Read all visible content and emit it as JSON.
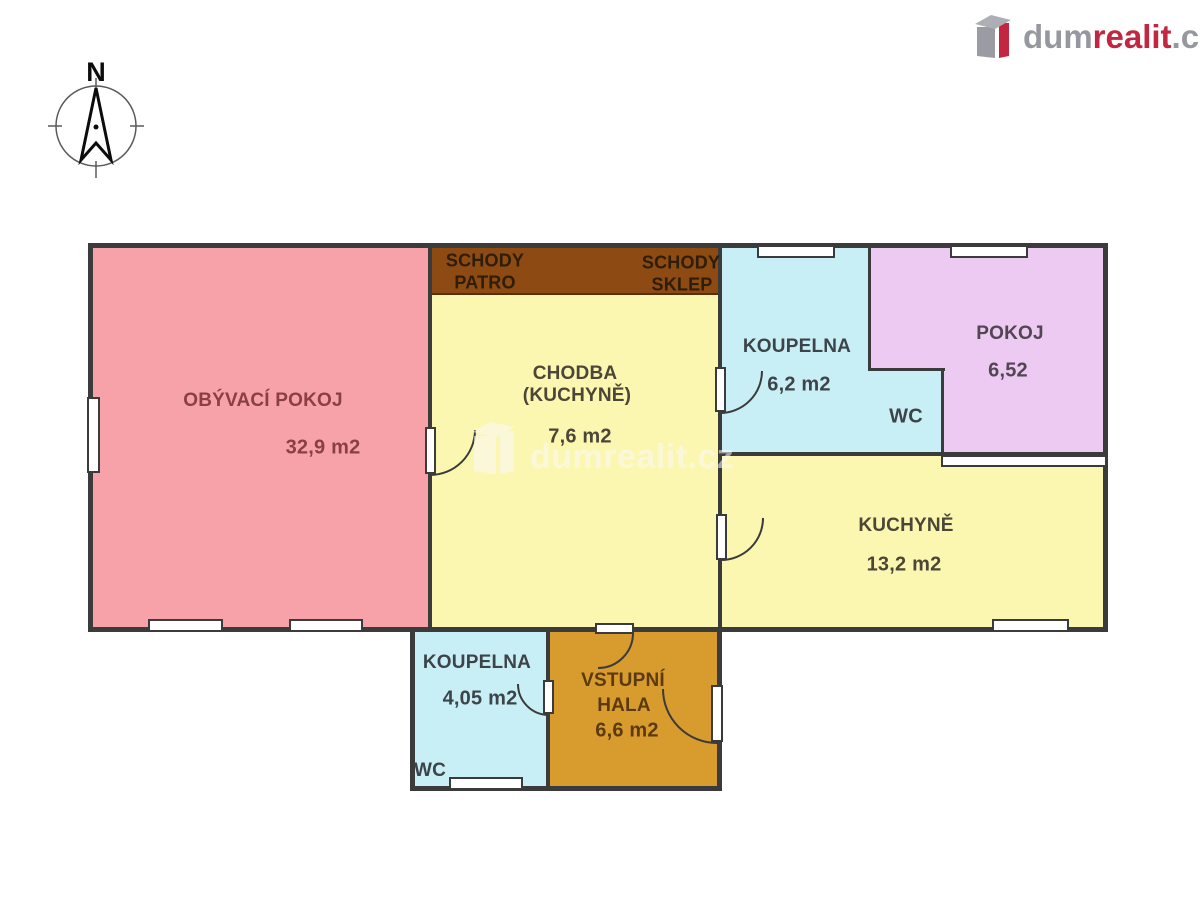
{
  "brand": {
    "dum": "dum",
    "realit": "realit",
    "cz": ".cz"
  },
  "compass": {
    "north": "N"
  },
  "watermark": {
    "text": "dumrealit.cz"
  },
  "plan": {
    "obyvaci_pokoj": {
      "name": "OBÝVACÍ POKOJ",
      "area": "32,9 m2"
    },
    "schody_patro": {
      "l1": "SCHODY",
      "l2": "PATRO"
    },
    "schody_sklep": {
      "l1": "SCHODY",
      "l2": "SKLEP"
    },
    "chodba": {
      "l1": "CHODBA",
      "l2": "(KUCHYNĚ)",
      "area": "7,6 m2"
    },
    "koupelna_horni": {
      "name": "KOUPELNA",
      "area": "6,2 m2",
      "wc": "WC"
    },
    "pokoj": {
      "name": "POKOJ",
      "area": "6,52"
    },
    "kuchyne": {
      "name": "KUCHYNĚ",
      "area": "13,2 m2"
    },
    "koupelna_dolni": {
      "name": "KOUPELNA",
      "area": "4,05 m2",
      "wc": "WC"
    },
    "vstupni_hala": {
      "l1": "VSTUPNÍ",
      "l2": "HALA",
      "area": "6,6 m2"
    }
  },
  "colors": {
    "living_pink": "#f6a2a8",
    "corridor_yellow": "#fbf7b0",
    "bathroom_blue": "#c9eff6",
    "room_purple": "#eccaf2",
    "hall_orange": "#d89b2e",
    "stairs_brown": "#8d4a12",
    "wall": "#3b3b3b",
    "brand_red": "#c22640",
    "brand_gray": "#97979f"
  }
}
